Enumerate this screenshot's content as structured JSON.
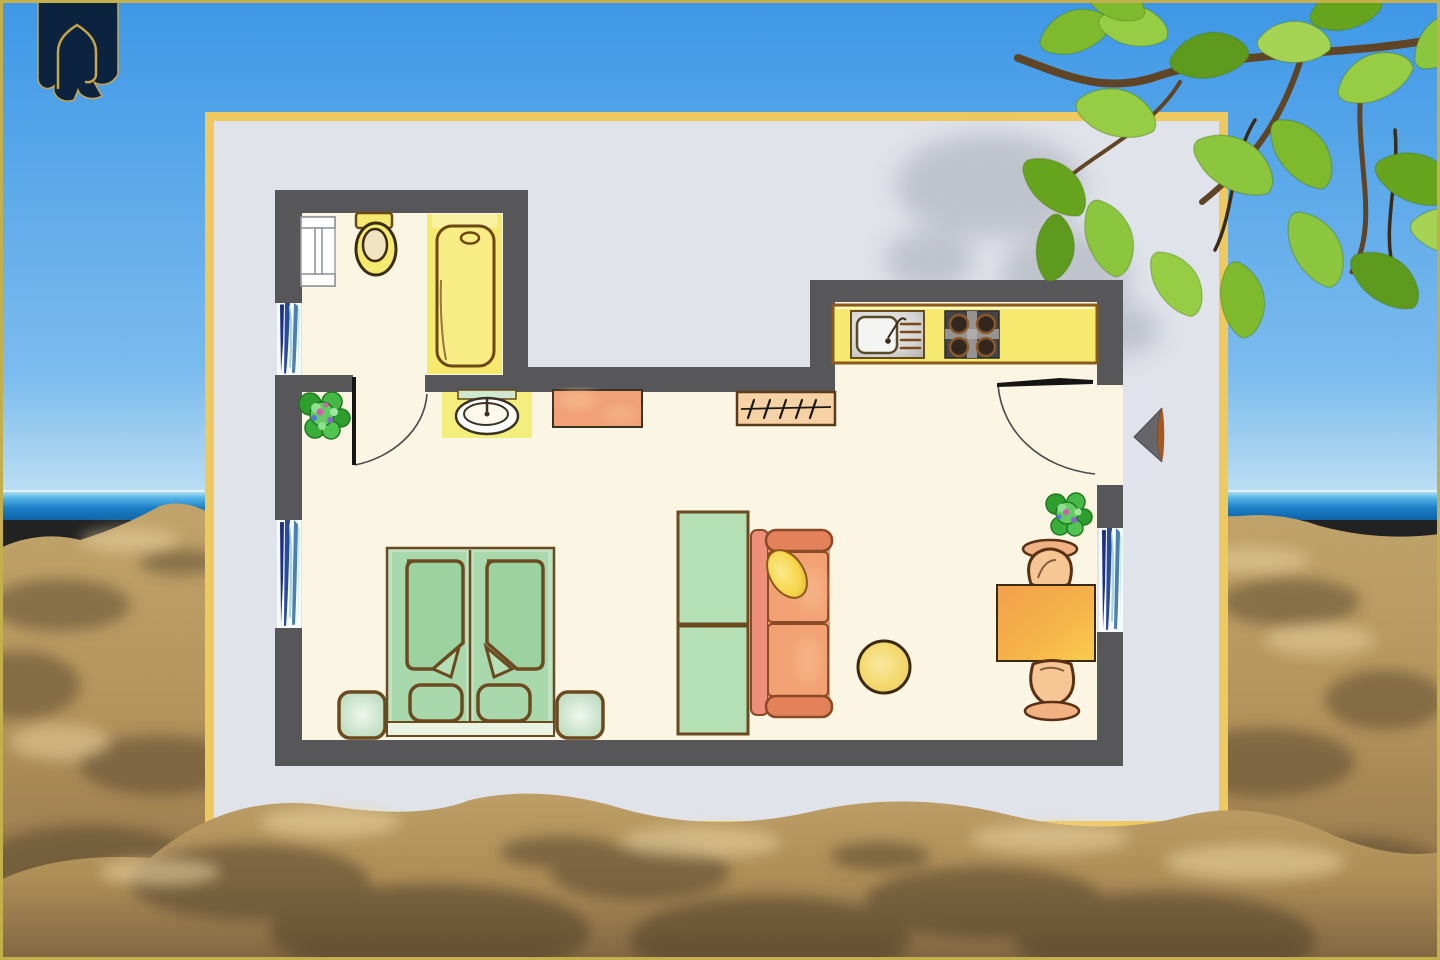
{
  "scene": {
    "kind": "floor-plan-poster-on-beach",
    "elements": [
      "sky",
      "sea",
      "beach-sand",
      "tree-branch-with-leaves",
      "logo-banner",
      "floor-plan-poster",
      "entrance-arrow"
    ]
  },
  "floorplan": {
    "type": "apartment-floor-plan",
    "rooms": [
      "bathroom",
      "main-living-sleeping-room",
      "kitchen-area",
      "entrance"
    ],
    "furniture": [
      "radiator",
      "toilet",
      "bathtub",
      "washbasin",
      "dresser",
      "wardrobe-with-hangers",
      "kitchen-counter",
      "kitchen-sink",
      "stove-with-four-burners",
      "double-bed",
      "blanket-left",
      "blanket-right",
      "pillow-left",
      "pillow-right",
      "nightstand-left",
      "nightstand-right",
      "shelf-unit",
      "sofa",
      "sofa-pillow",
      "side-stool",
      "dining-table",
      "chair-top",
      "chair-bottom",
      "plant-hall",
      "plant-entrance",
      "window-bathroom",
      "window-left",
      "window-right",
      "door-bathroom",
      "door-entrance"
    ]
  },
  "colors": {
    "sky_top": "#3e97e6",
    "sky_horizon": "#bfe0f2",
    "sea_deep": "#0e63a8",
    "sea_light": "#58b7e8",
    "sand": "#c8a263",
    "sand_dark": "#6e5637",
    "sand_light": "#e9d3a2",
    "paper": "#e0e3ea",
    "poster_border": "#eec95f",
    "frame": "#c3b04c",
    "wall": "#57575a",
    "floor": "#fbf6e4",
    "outline": "#7a4b16",
    "fixture_yellow": "#f6e96f",
    "fixture_pale": "#f9f1a2",
    "mat_yellow": "#f4ee7d",
    "sink_gray": "#c9c9c7",
    "stove_gray": "#454346",
    "burner_dark": "#33261e",
    "bed_green": "#a9d8ac",
    "bed_frame_green": "#c0e2c1",
    "blanket_green": "#9cd1a0",
    "nightstand_green": "#c8e2c9",
    "unit_green": "#b5e0b6",
    "sofa_orange": "#f0976b",
    "sofa_arm": "#e2815a",
    "cushion_light": "#f6b78c",
    "backrest_orange": "#ee8f79",
    "pillow_yellow": "#f6d549",
    "table_orange": "#f2a04b",
    "table_gold": "#fbcc4d",
    "chair_tan": "#f3c291",
    "wood_dark": "#5a3014",
    "dresser_orange": "#f1a077",
    "wardrobe_tan": "#f6d2a4",
    "stool_yellow": "#f3d96e",
    "window_navy": "#1c2f80",
    "window_blue": "#4b7fb0",
    "window_pale": "#a8d8d8",
    "plant_green": "#35a835",
    "plant_light": "#7ed47e",
    "flower_pink": "#d45fb0",
    "flower_purple": "#8f62d6",
    "leaf_mid": "#7fba2e",
    "leaf_dark": "#5d9a1d",
    "leaf_light": "#a5d455",
    "branch_brown": "#5f4426",
    "logo_navy": "#0c2340",
    "logo_gold": "#c7a64b",
    "door_line": "#151515",
    "arrow_gray": "#66666a",
    "arrow_brown": "#a35a20"
  }
}
